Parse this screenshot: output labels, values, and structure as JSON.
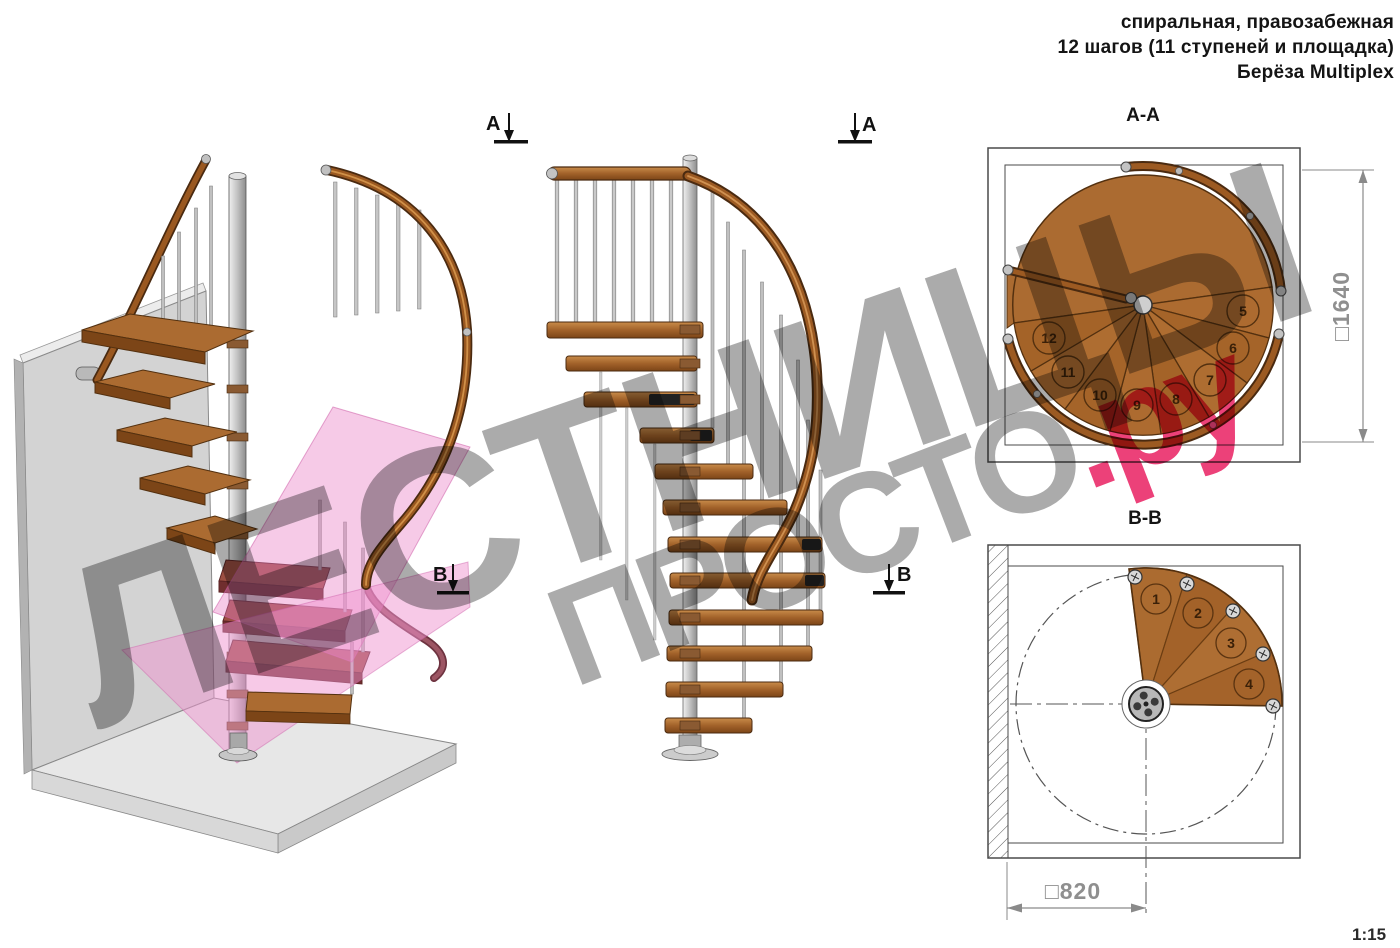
{
  "header": {
    "line1": "спиральная, правозабежная",
    "line2": "12 шагов (11 ступеней и площадка)",
    "line3": "Берёза Multiplex"
  },
  "watermark": {
    "line1": "ЛЕСТНИЦЫ",
    "line2_gray": "ПРОСТО",
    "line2_pink": ".ру",
    "gray_color": "#ababab",
    "pink_color": "#ec4179"
  },
  "section_aa": {
    "title": "A-A",
    "dimension": "□1640",
    "step_numbers": [
      "5",
      "6",
      "7",
      "8",
      "9",
      "10",
      "11",
      "12"
    ]
  },
  "section_bb": {
    "title": "B-B",
    "dimension": "□820",
    "step_numbers": [
      "1",
      "2",
      "3",
      "4"
    ]
  },
  "markers": {
    "a": "A",
    "b": "B"
  },
  "scale": "1:15",
  "colors": {
    "wood": "#a9682e",
    "wood_dark": "#53300f",
    "rail": "#9c5a22",
    "metal": "#c9c9c9",
    "pink_plane": "#ec82c4",
    "dim_gray": "#8f8f8f"
  }
}
